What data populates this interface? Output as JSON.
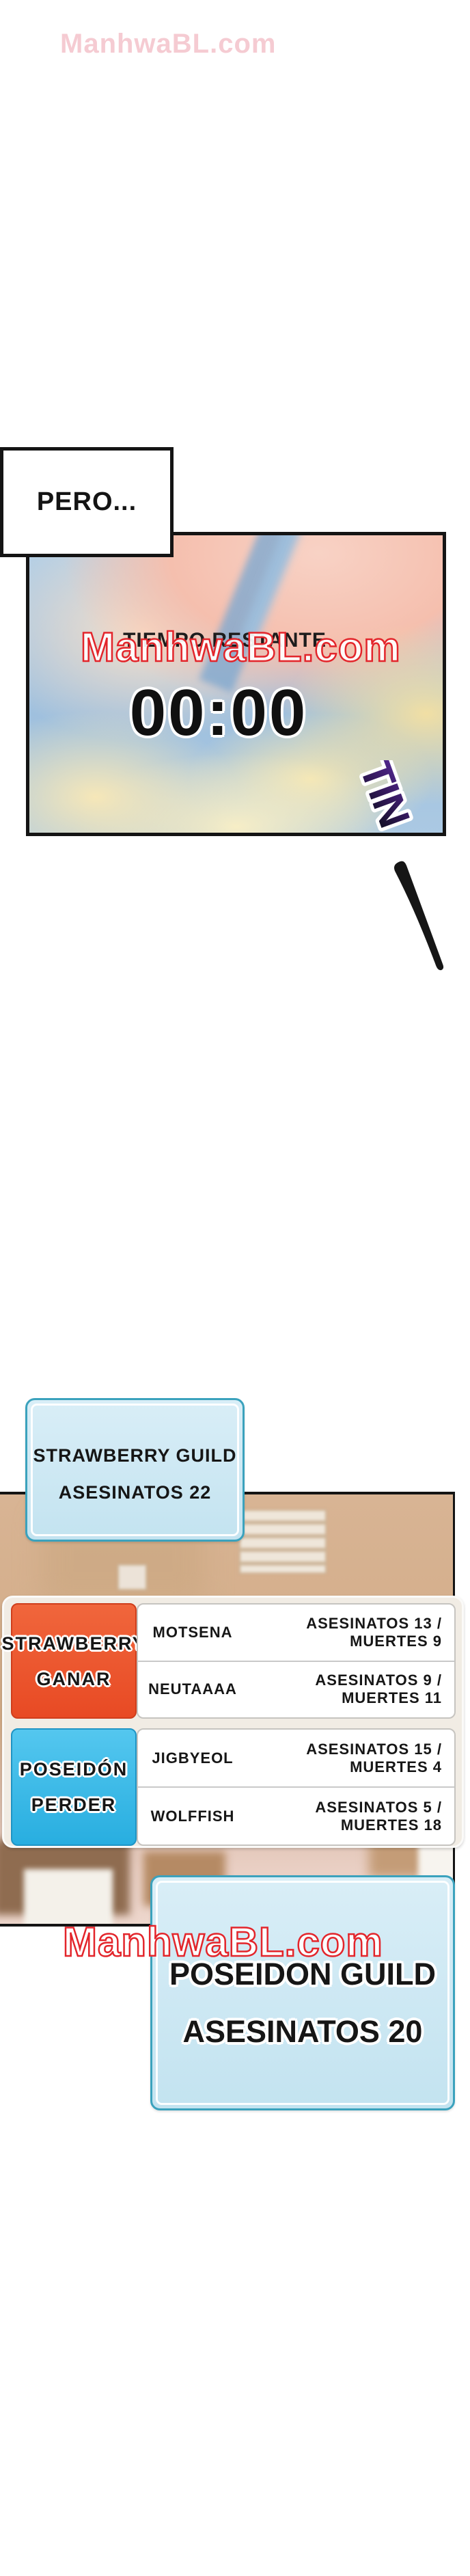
{
  "watermarks": {
    "top": {
      "text": "ManhwaBL.com"
    },
    "sky": {
      "text": "ManhwaBL.com"
    },
    "bottom": {
      "text": "ManhwaBL.com"
    },
    "stroke_color": "#e3252b"
  },
  "speech": {
    "pero": "PERO..."
  },
  "timer": {
    "label": "TIEMPO RESTANTE",
    "value": "00:00"
  },
  "sfx": {
    "tin": "TIN"
  },
  "banners": {
    "strawberry": {
      "line1": "STRAWBERRY GUILD",
      "line2": "ASESINATOS 22"
    },
    "poseidon": {
      "line1": "POSEIDON GUILD",
      "line2": "ASESINATOS 20"
    }
  },
  "scoreboard": {
    "teams": [
      {
        "name": "STRAWBERRY",
        "result": "GANAR",
        "color": "#eb4f2b",
        "players": [
          {
            "name": "MOTSENA",
            "stats": "ASESINATOS 13 / MUERTES 9"
          },
          {
            "name": "NEUTAAAA",
            "stats": "ASESINATOS 9 / MUERTES 11"
          }
        ]
      },
      {
        "name": "POSEIDÓN",
        "result": "PERDER",
        "color": "#2db3e5",
        "players": [
          {
            "name": "JIGBYEOL",
            "stats": "ASESINATOS 15 / MUERTES 4"
          },
          {
            "name": "WOLFFISH",
            "stats": "ASESINATOS 5 / MUERTES 18"
          }
        ]
      }
    ]
  },
  "colors": {
    "team_strawberry": "#eb4f2b",
    "team_poseidon": "#2db3e5",
    "banner_fill": "#c9e6f2",
    "banner_border": "#3ba2bd",
    "watermark_red": "#e3252b",
    "sfx_purple": "#4a2488",
    "panel_tan": "#d6b290"
  }
}
